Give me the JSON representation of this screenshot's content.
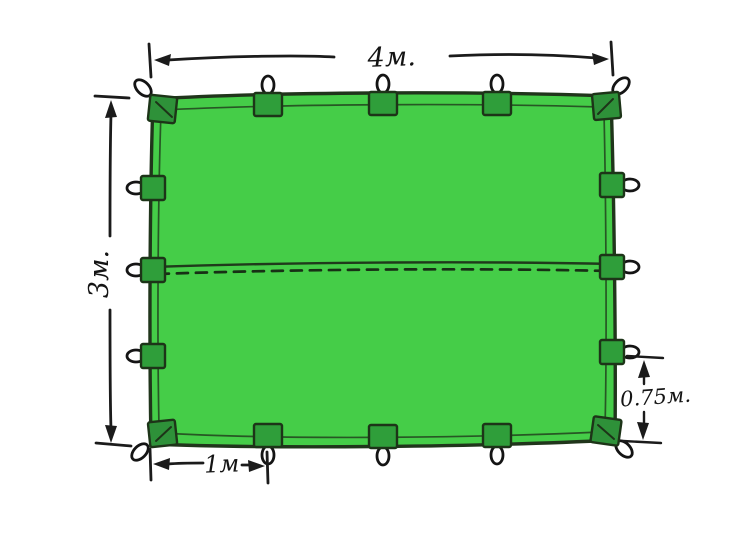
{
  "diagram": {
    "labels": {
      "width": "4м.",
      "height": "3м.",
      "bottom_loop_spacing": "1м",
      "side_loop_spacing": "0.75м."
    },
    "measurements": {
      "width_m": 4,
      "height_m": 3,
      "bottom_loop_spacing_m": 1,
      "side_loop_spacing_m": 0.75
    },
    "loops": {
      "top_edge": 5,
      "bottom_edge": 5,
      "left_edge": 5,
      "right_edge": 5,
      "corner_loops": 4,
      "total": 16
    },
    "colors": {
      "tarp_fill": "#45cd48",
      "tab_fill": "#2f9e3a",
      "outline": "#20351b",
      "ink": "#1b1b1b",
      "background": "#ffffff"
    }
  }
}
